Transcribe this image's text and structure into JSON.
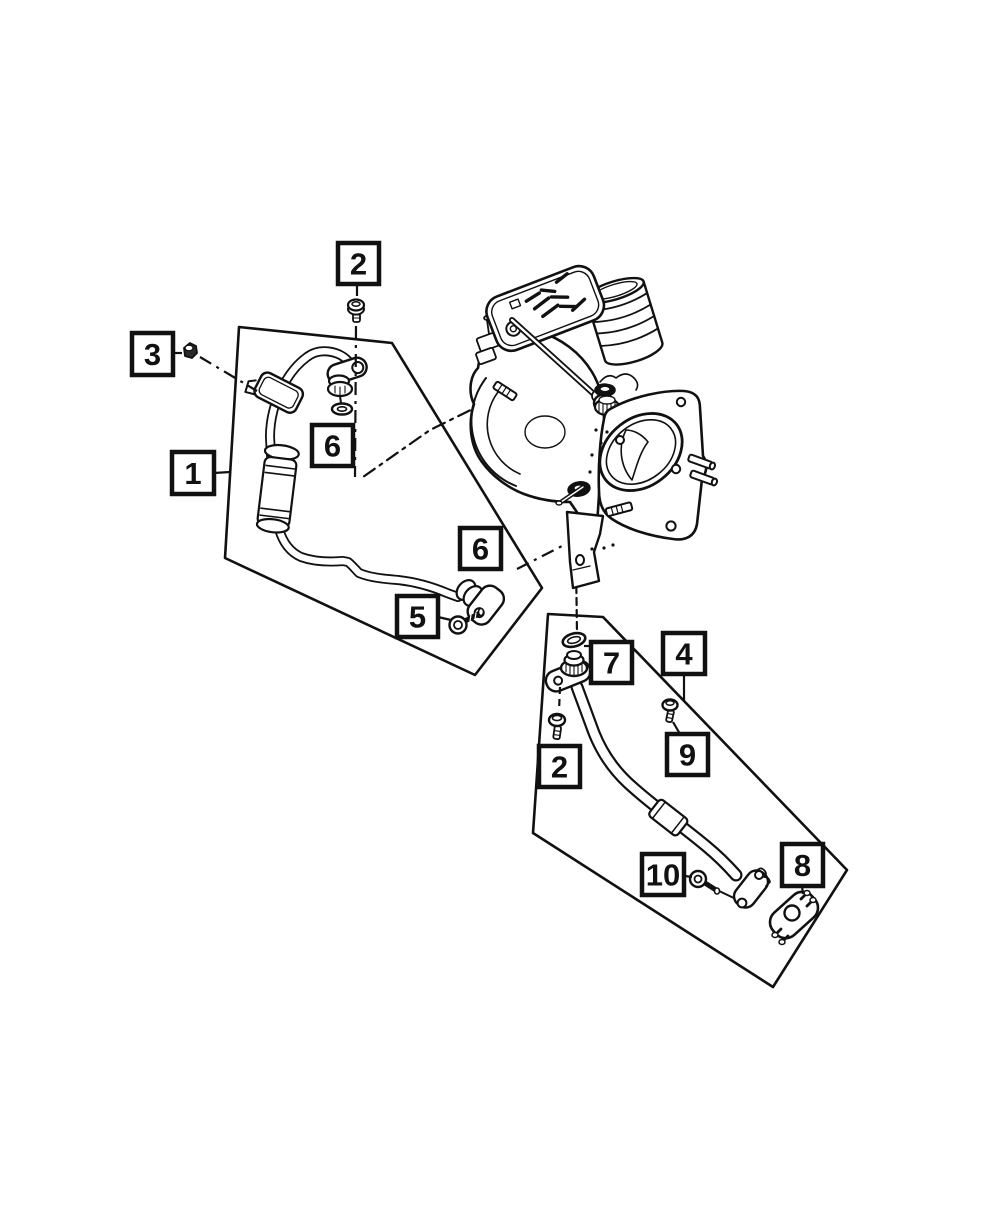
{
  "diagram": {
    "background": "#ffffff",
    "ink": "#111111",
    "leader_dash": {
      "solid": "",
      "dashed": "7 5",
      "dashdot": "13 6 3 6"
    },
    "callouts": [
      {
        "name": "callout-2-upper",
        "label": "2",
        "box": [
          338,
          243,
          41,
          41
        ],
        "leaders": [
          {
            "style": "solid",
            "points": [
              [
                357,
                284
              ],
              [
                357,
                296
              ]
            ]
          },
          {
            "style": "dashdot",
            "points": [
              [
                356,
                326
              ],
              [
                355,
                477
              ]
            ]
          }
        ]
      },
      {
        "name": "callout-3",
        "label": "3",
        "box": [
          132,
          333,
          41,
          42
        ],
        "leaders": [
          {
            "style": "solid",
            "points": [
              [
                173,
                353
              ],
              [
                182,
                353
              ]
            ]
          },
          {
            "style": "dashdot",
            "points": [
              [
                200,
                357
              ],
              [
                257,
                391
              ]
            ]
          }
        ]
      },
      {
        "name": "callout-1",
        "label": "1",
        "box": [
          172,
          452,
          42,
          42
        ],
        "leaders": [
          {
            "style": "solid",
            "points": [
              [
                214,
                473
              ],
              [
                230,
                472
              ]
            ]
          }
        ]
      },
      {
        "name": "callout-6-upper",
        "label": "6",
        "box": [
          312,
          425,
          41,
          41
        ],
        "leaders": []
      },
      {
        "name": "callout-6-lower",
        "label": "6",
        "box": [
          460,
          528,
          41,
          41
        ],
        "leaders": [
          {
            "style": "dashdot",
            "points": [
              [
                517,
                569
              ],
              [
                566,
                544
              ]
            ]
          }
        ]
      },
      {
        "name": "callout-5",
        "label": "5",
        "box": [
          397,
          596,
          41,
          41
        ],
        "leaders": [
          {
            "style": "solid",
            "points": [
              [
                438,
                617
              ],
              [
                451,
                620
              ]
            ]
          }
        ]
      },
      {
        "name": "callout-7",
        "label": "7",
        "box": [
          591,
          642,
          41,
          41
        ],
        "leaders": [
          {
            "style": "solid",
            "points": [
              [
                584,
                646
              ],
              [
                591,
                646
              ]
            ]
          }
        ]
      },
      {
        "name": "callout-4",
        "label": "4",
        "box": [
          663,
          633,
          42,
          41
        ],
        "leaders": [
          {
            "style": "solid",
            "points": [
              [
                684,
                675
              ],
              [
                684,
                701
              ]
            ]
          }
        ]
      },
      {
        "name": "callout-2-lower",
        "label": "2",
        "box": [
          539,
          746,
          41,
          41
        ],
        "leaders": [
          {
            "style": "dashed",
            "points": [
              [
                560,
                687
              ],
              [
                559,
                711
              ]
            ]
          }
        ]
      },
      {
        "name": "callout-9",
        "label": "9",
        "box": [
          667,
          734,
          41,
          41
        ],
        "leaders": [
          {
            "style": "solid",
            "points": [
              [
                673,
                722
              ],
              [
                680,
                734
              ]
            ]
          }
        ]
      },
      {
        "name": "callout-10",
        "label": "10",
        "box": [
          642,
          854,
          42,
          41
        ],
        "leaders": [
          {
            "style": "solid",
            "points": [
              [
                685,
                876
              ],
              [
                692,
                877
              ]
            ]
          }
        ]
      },
      {
        "name": "callout-8",
        "label": "8",
        "box": [
          782,
          844,
          41,
          42
        ],
        "leaders": [
          {
            "style": "solid",
            "points": [
              [
                802,
                886
              ],
              [
                803,
                894
              ]
            ]
          }
        ]
      }
    ]
  }
}
